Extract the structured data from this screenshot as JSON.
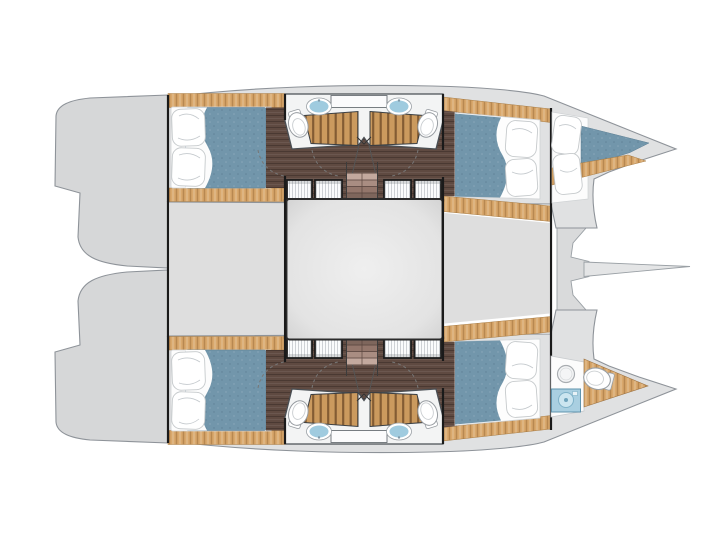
{
  "meta": {
    "title": "Catamaran interior deck plan",
    "kind": "boat floor plan, top view, bow to the right",
    "text_on_image": ""
  },
  "colors": {
    "background": "#ffffff",
    "hull": "#e0e1e2",
    "transom": "#d6d7d8",
    "panel": "#dedede",
    "beam": "#d9dadb",
    "bowsprit": "#e4e5e6",
    "wood": "#d9a86c",
    "walnut": "#5f4a41",
    "grate": "#cb9a5e",
    "mattress": "#7296ab",
    "sheet": "#fdfdfd",
    "locker": "#fafbfc",
    "sink": "#9fcbdf",
    "sinkBox": "#a9cfe1",
    "toilet": "#ffffff",
    "cabinet": "#fbfbfc",
    "bathFloor": "#f3f4f4",
    "stair1": "#c3a99e",
    "stair2": "#a98d82",
    "stair3": "#93766b",
    "stair4": "#7e665c"
  },
  "spaces": {
    "hull_top": [
      "aft double cabin",
      "aft bathroom with shower",
      "forward bathroom with shower",
      "forward double cabin",
      "bow berth"
    ],
    "hull_bottom": [
      "aft double cabin",
      "aft bathroom with shower",
      "forward bathroom with shower",
      "forward double cabin",
      "bow head with toilet"
    ],
    "bridgedeck": [
      "aft platform",
      "saloon floor",
      "forward platform",
      "forward crossbeam",
      "bowsprit"
    ]
  },
  "fixtures": {
    "double_beds": 4,
    "bow_berths": 1,
    "toilets": 5,
    "sinks": 5,
    "shower_gratings": 4,
    "wardrobe_lockers": 8,
    "companionway_stairs": 2,
    "door_swings": 6
  }
}
